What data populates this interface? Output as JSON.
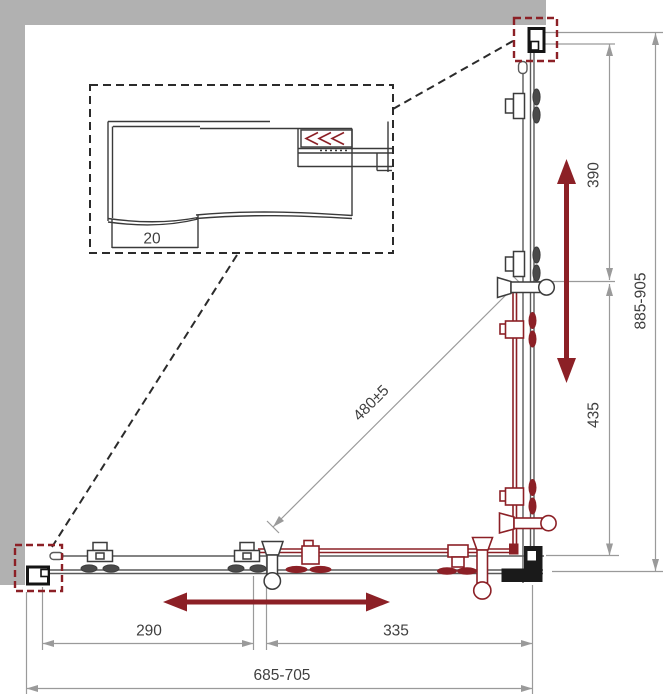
{
  "title": "Corner shower enclosure dimensional drawing (plan view)",
  "labels": {
    "detail_depth": "20",
    "right_upper": "390",
    "right_lower": "435",
    "right_overall": "885-905",
    "diagonal": "480±5",
    "bottom_left_segment": "290",
    "bottom_right_segment": "335",
    "bottom_overall": "685-705"
  },
  "icons": {
    "slide_direction_vertical": "double-headed-arrow-vertical",
    "slide_direction_horizontal": "double-headed-arrow-horizontal",
    "glass_insertion": "triple-chevron-left",
    "wall_profile_highlight": "dashed-red-box",
    "detail_callout": "dashed-black-box"
  },
  "colors": {
    "wall": "#b1b1b1",
    "accent_red": "#8c2026",
    "hardware_dark": "#1a1a1a",
    "glass_line": "#5a5a5a",
    "dimension_gray": "#9a9a9a",
    "text": "#3f3f3f",
    "background": "#ffffff"
  }
}
